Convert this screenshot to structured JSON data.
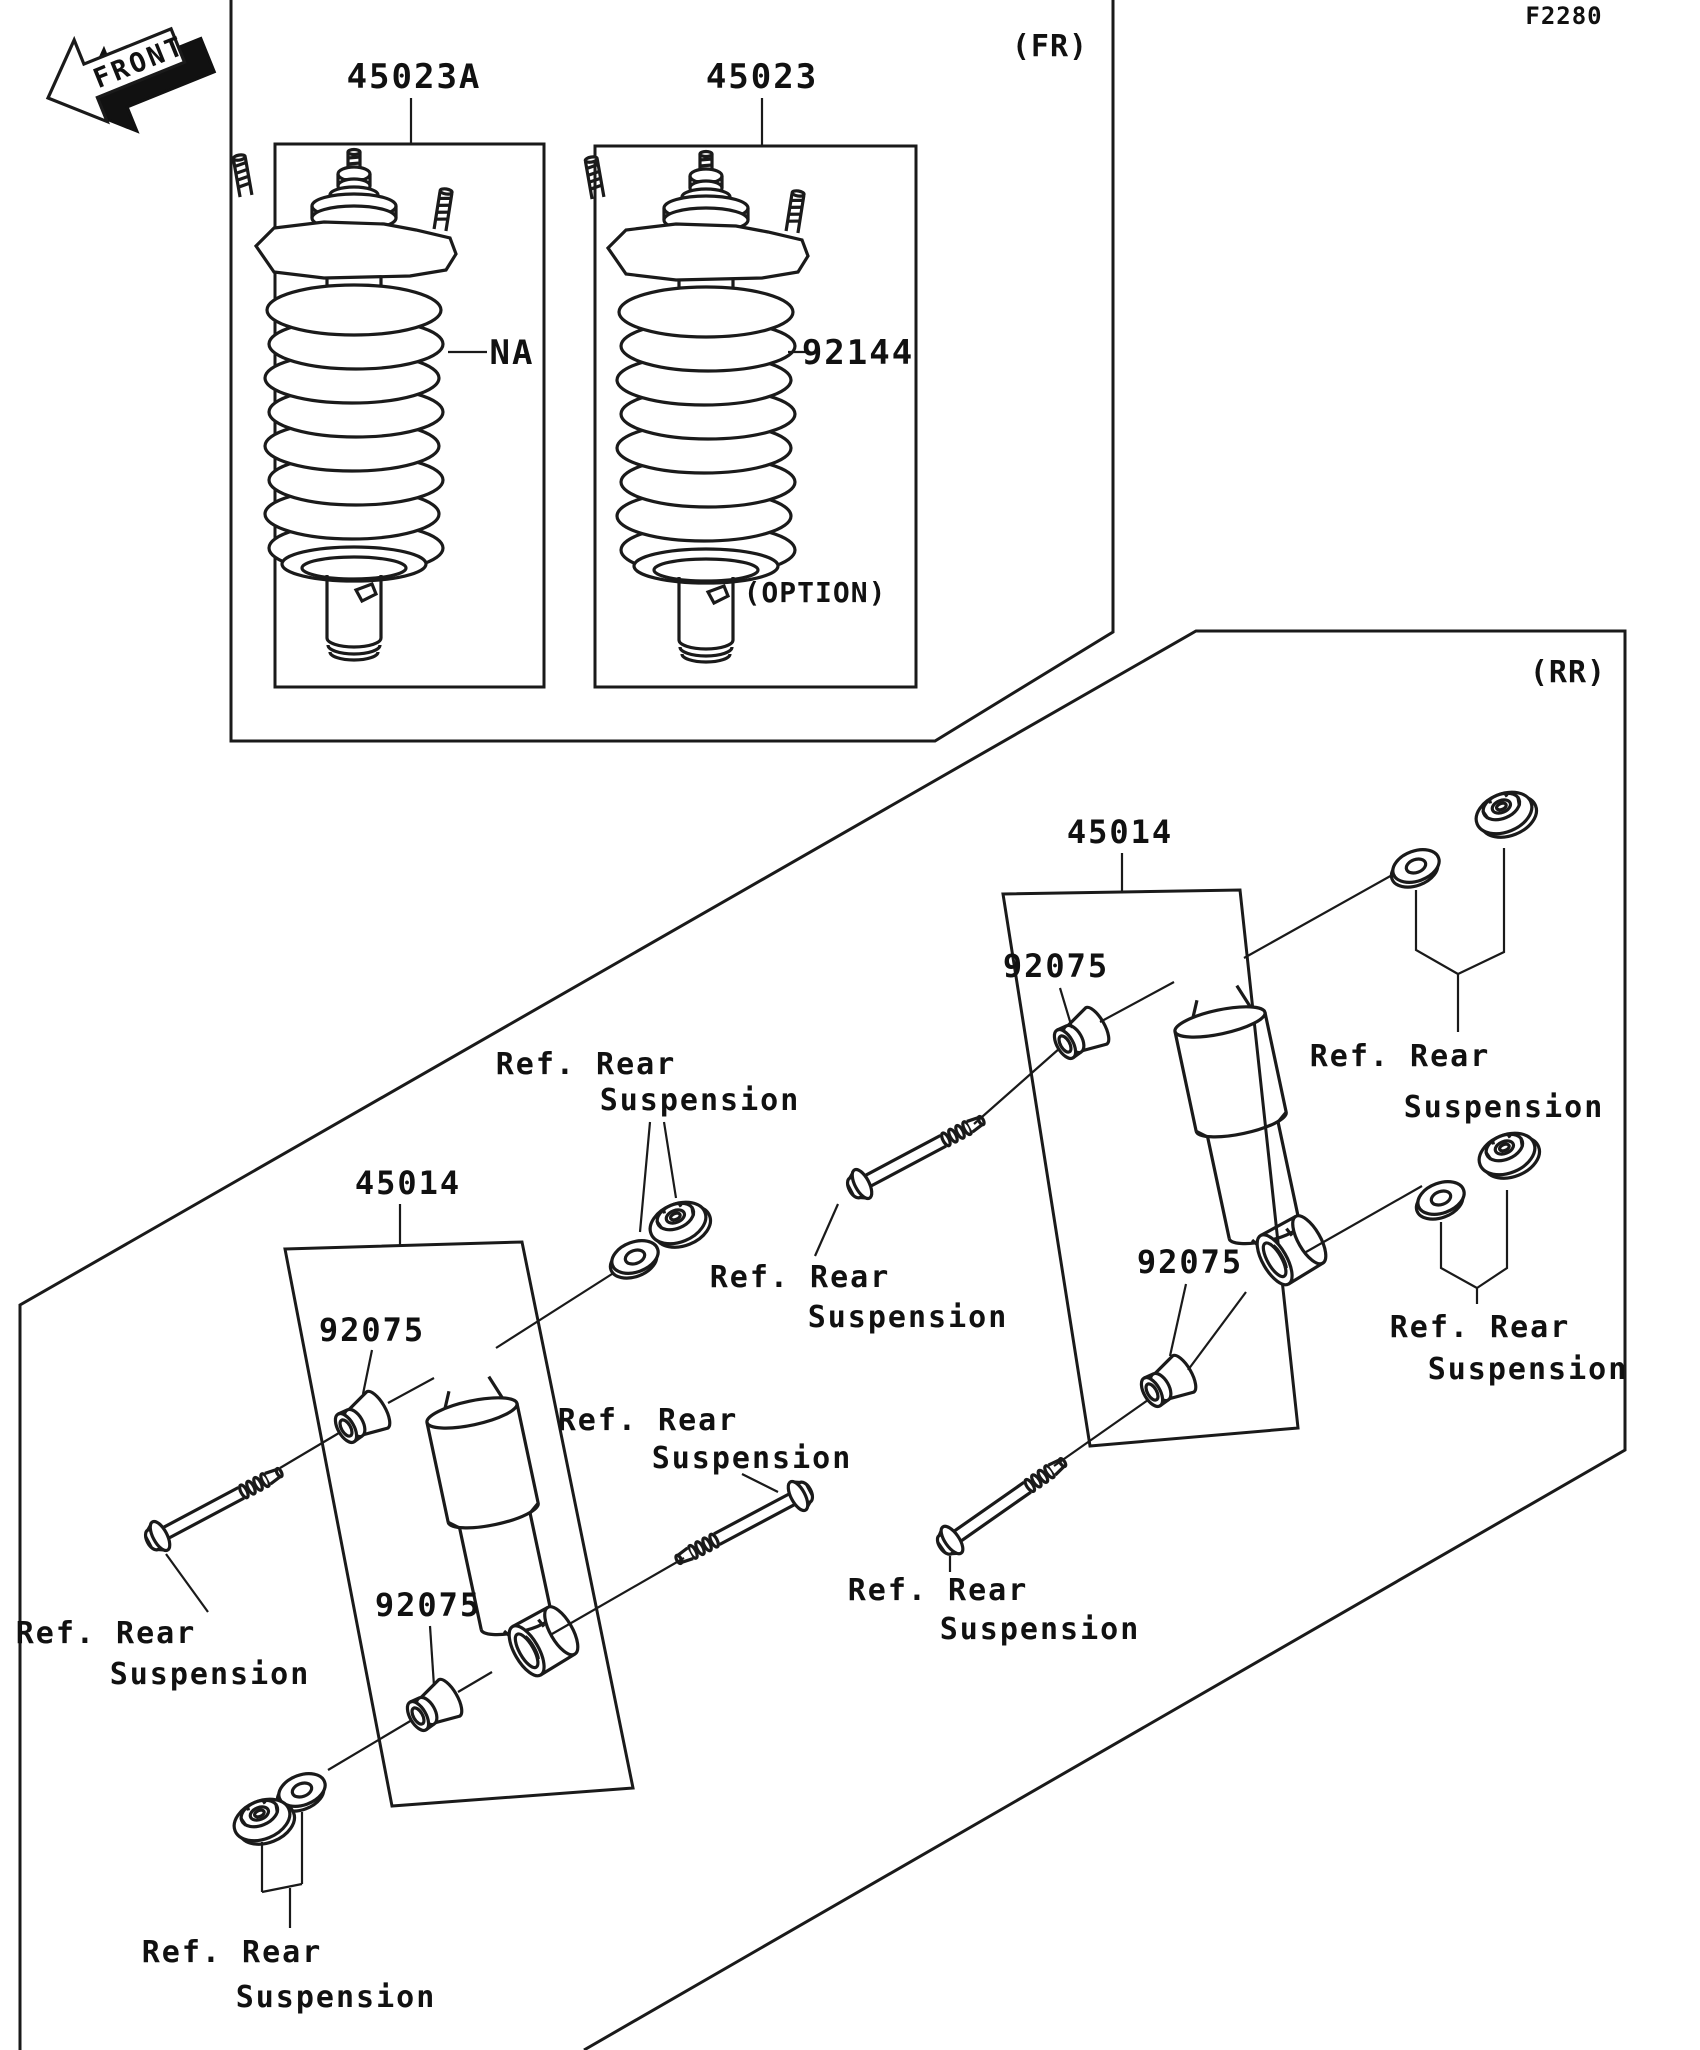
{
  "drawing_code": "F2280",
  "front_arrow": {
    "label": "FRONT"
  },
  "front_section": {
    "section_label": "(FR)",
    "option_label": "(OPTION)",
    "shocks": [
      {
        "part_no": "45023A",
        "spring_label": "NA"
      },
      {
        "part_no": "45023",
        "spring_label": "92144"
      }
    ]
  },
  "rear_section": {
    "section_label": "(RR)",
    "ref_line1": "Ref. Rear",
    "ref_line2": "Suspension",
    "assemblies": [
      {
        "part_no": "45014",
        "bushing_upper": "92075",
        "bushing_lower": "92075"
      },
      {
        "part_no": "45014",
        "bushing_upper": "92075",
        "bushing_lower": "92075"
      }
    ]
  }
}
